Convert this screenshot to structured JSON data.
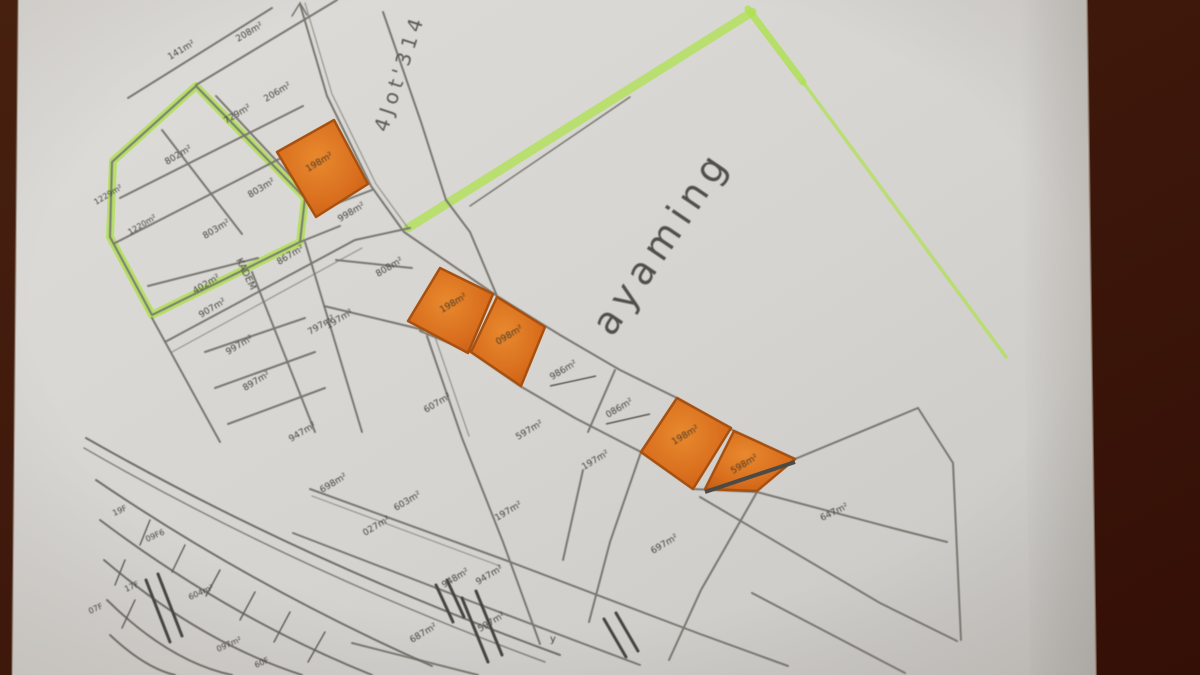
{
  "colors": {
    "background": "#421a0d",
    "paper": "#d7d5d1",
    "highlighter": "#aee14f",
    "plot_orange": "#d96f1e",
    "pencil": "#78776f",
    "ink": "#45443f"
  },
  "annotations": {
    "top_street": "4Jot'314",
    "area_name": "ayaming",
    "road_name": "KADEM"
  },
  "plot_labels": [
    "141m²",
    "208m²",
    "206m²",
    "729m²",
    "802m²",
    "803m²",
    "1229m²",
    "1220m²",
    "803m²",
    "402m²",
    "867m²",
    "907m²",
    "997m²",
    "897m²",
    "797m²",
    "947m²",
    "198m²",
    "998m²",
    "808m²",
    "197m²",
    "198m²",
    "098m²",
    "986m²",
    "086m²",
    "198m²",
    "598m²",
    "607m²",
    "597m²",
    "197m²",
    "698m²",
    "603m²",
    "027m²",
    "197m²",
    "697m²",
    "948m²",
    "947m²",
    "687m²",
    "597m²",
    "647m²"
  ],
  "fan_labels": [
    "19F",
    "09F6",
    "17F",
    "07F",
    "604m²",
    "097m²",
    "60F"
  ],
  "marks": {
    "y_mark": "y"
  }
}
